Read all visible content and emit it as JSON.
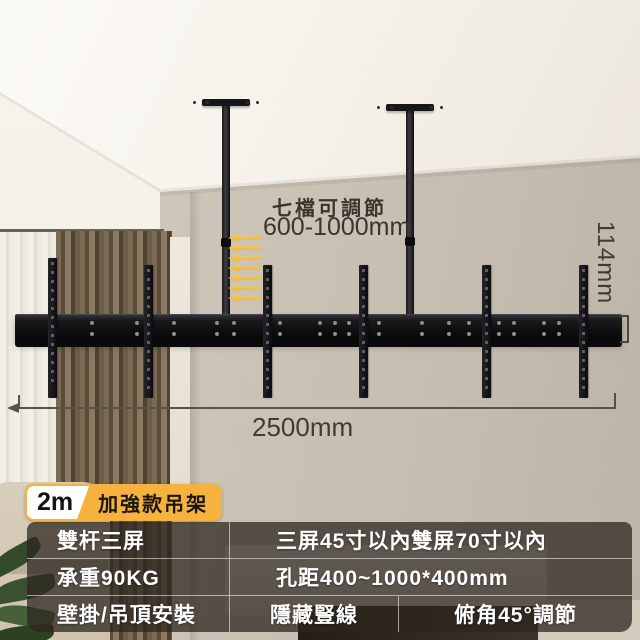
{
  "annotations": {
    "adjust_title": "七檔可調節",
    "adjust_range": "600-1000mm",
    "width_label": "2500mm",
    "rail_height_label": "114mm",
    "arrow_count": 7
  },
  "badge": {
    "size_label": "2m",
    "name_label": "加強款吊架"
  },
  "spec_table": {
    "rows": [
      [
        "雙杆三屏",
        "三屏45寸以內雙屏70寸以內"
      ],
      [
        "承重90KG",
        "孔距400~1000*400mm"
      ],
      [
        "壁掛/吊頂安裝",
        "隱藏豎線",
        "俯角45°調節"
      ]
    ]
  },
  "colors": {
    "accent_yellow": "#f5b23e",
    "arrow_yellow": "#f2c04a",
    "table_background": "rgba(45,38,31,0.74)",
    "annotation_text": "#3a362f"
  }
}
